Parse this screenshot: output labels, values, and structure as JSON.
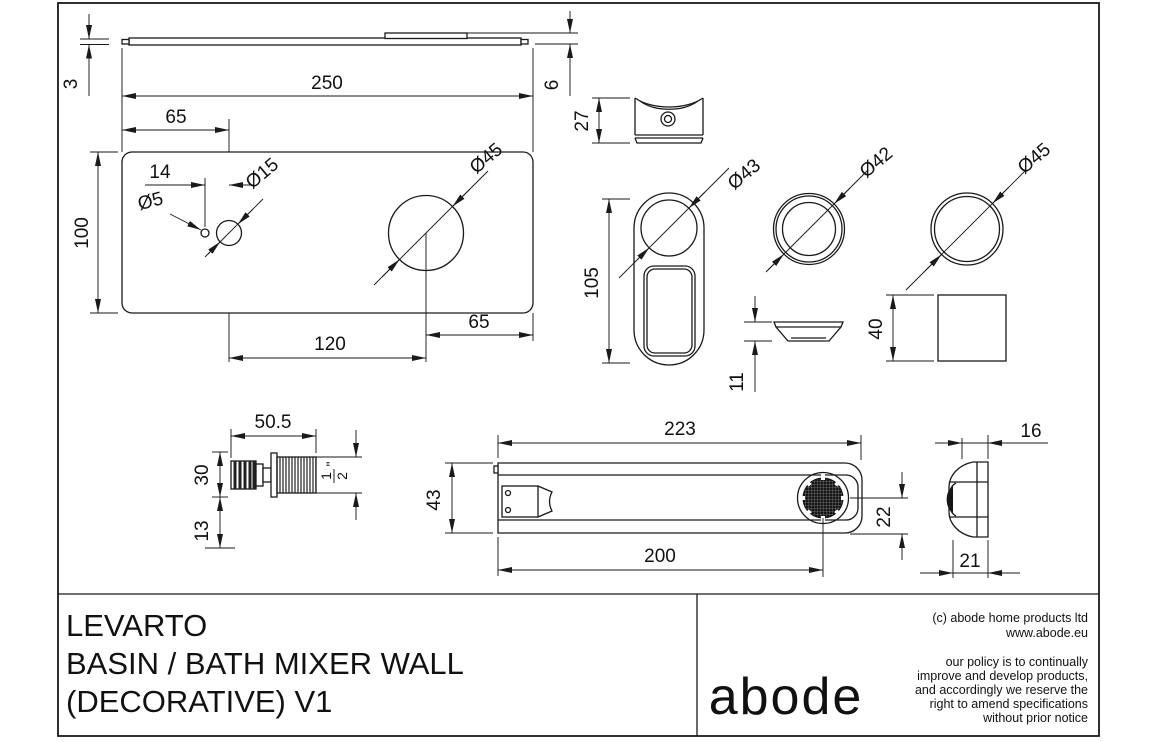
{
  "title_block": {
    "product": [
      "LEVARTO",
      "BASIN / BATH MIXER WALL",
      "(DECORATIVE) V1"
    ],
    "brand": "abode",
    "copyright": [
      "(c) abode home products ltd",
      "www.abode.eu"
    ],
    "policy": [
      "our policy is to continually",
      "improve and develop products,",
      "and accordingly we reserve the",
      "right to amend specifications",
      "without prior notice"
    ]
  },
  "dims": {
    "plate_thickness": "3",
    "plate_width": "250",
    "hole_offset_left": "65",
    "total_depth": "6",
    "plate_height": "100",
    "screw_hole_pitch": "14",
    "dia_screw": "Ø5",
    "dia_small": "Ø15",
    "dia_large": "Ø45",
    "hole_pitch": "120",
    "hole_offset_right": "65",
    "trim_depth": "27",
    "trim_height": "105",
    "dia_trim": "Ø43",
    "dia_ring": "Ø42",
    "dia_cap": "Ø45",
    "dish_depth": "11",
    "square_size": "40",
    "tail_length": "50.5",
    "tail_dia": "30",
    "tail_offset": "13",
    "thread_num": "1",
    "thread_den": "2",
    "thread_unit": "\"",
    "spout_length": "223",
    "spout_width": "43",
    "spout_reach": "200",
    "aerator_offset": "22",
    "end_top": "16",
    "end_bottom": "21"
  }
}
